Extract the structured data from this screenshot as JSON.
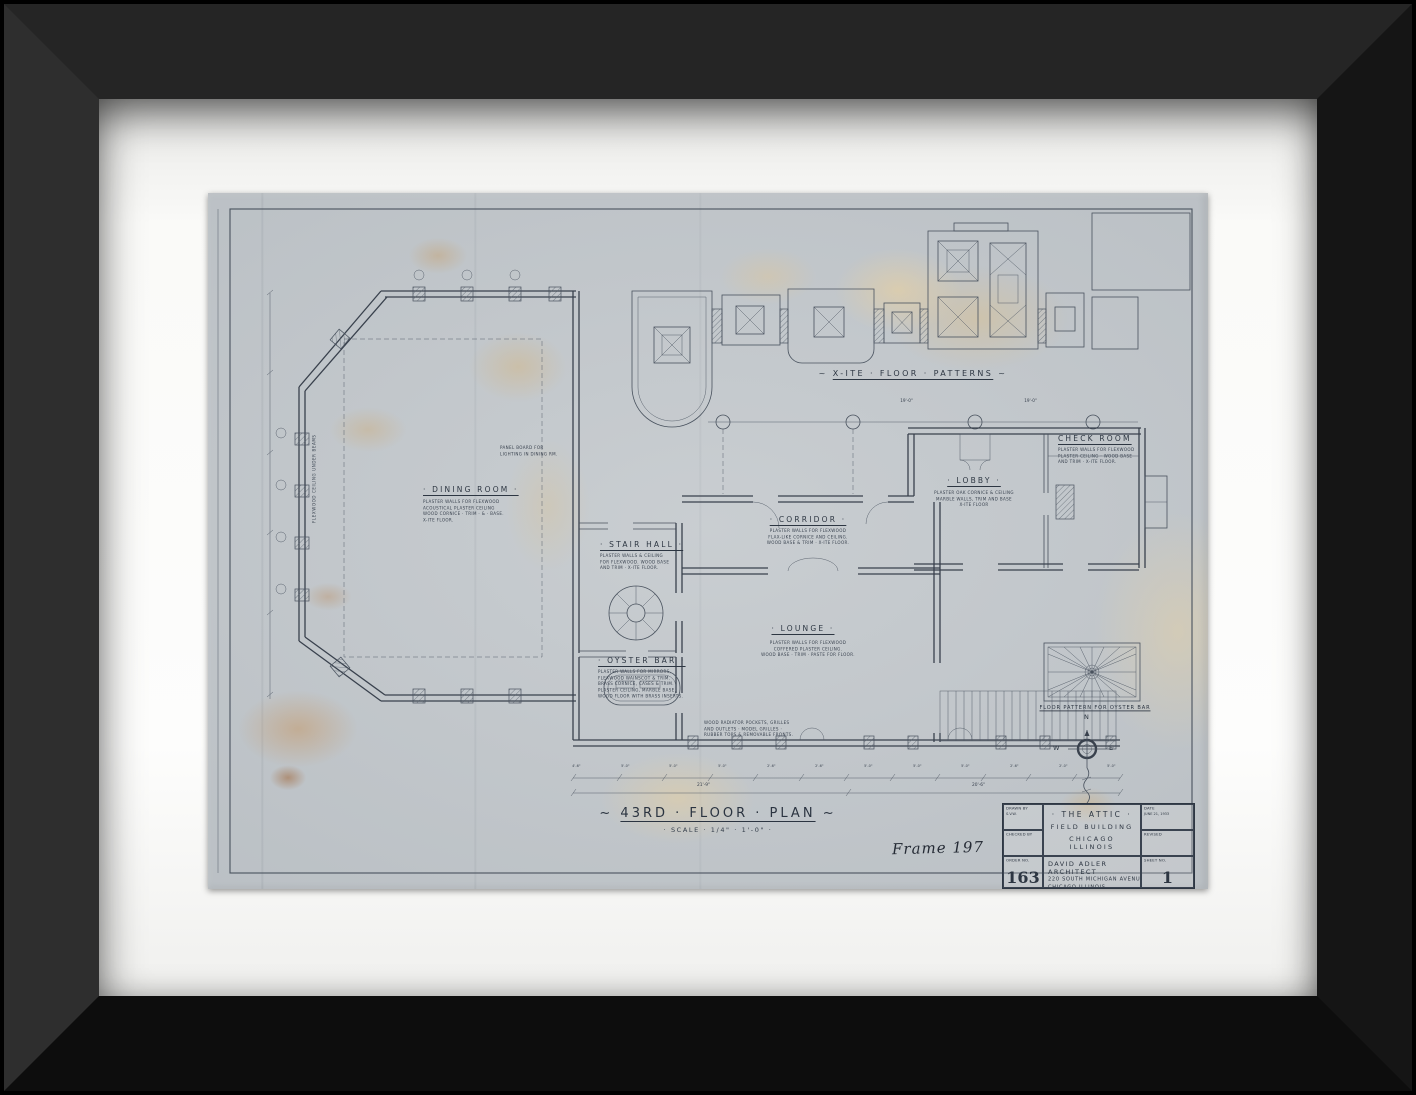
{
  "drawing": {
    "title_prefix": "~",
    "title_main": "43RD · FLOOR · PLAN",
    "title_suffix": "~",
    "scale_note": "· SCALE · 1/4\" · 1'-0\" ·",
    "handwritten_note": "Frame 197",
    "patterns_prefix": "~",
    "patterns_main": "X-ITE · FLOOR · PATTERNS",
    "patterns_suffix": "~",
    "patterns_dim_left": "19'-0\"",
    "patterns_dim_right": "19'-0\"",
    "oyster_pattern_caption": "FLOOR PATTERN FOR OYSTER BAR",
    "compass": {
      "north": "N",
      "west": "W",
      "east": "E"
    },
    "rooms": {
      "dining": {
        "name": "· DINING ROOM ·",
        "notes": "PLASTER WALLS FOR FLEXWOOD\nACOUSTICAL PLASTER CEILING\nWOOD CORNICE · TRIM · & · BASE.\nX-ITE FLOOR."
      },
      "stair_hall": {
        "name": "· STAIR HALL ·",
        "notes": "PLASTER WALLS & CEILING\nFOR FLEXWOOD. WOOD BASE\nAND TRIM · X-ITE FLOOR."
      },
      "oyster_bar": {
        "name": "· OYSTER BAR ·",
        "notes": "PLASTER WALLS FOR MIRRORS,\nFLEXWOOD WAINSCOT & TRIM.\nBRASS CORNICE, CASES & TRIM.\nPLASTER CEILING, MARBLE BASE.\nWOOD FLOOR WITH BRASS INSERTS."
      },
      "lounge": {
        "name": "· LOUNGE ·",
        "notes": "PLASTER WALLS FOR FLEXWOOD\nCOFFERED PLASTER CEILING.\nWOOD BASE · TRIM · PASTE FOR FLOOR."
      },
      "corridor": {
        "name": "· CORRIDOR ·",
        "notes": "PLASTER WALLS FOR FLEXWOOD\nFLAX-LIKE CORNICE AND CEILING.\nWOOD BASE & TRIM · X-ITE FLOOR."
      },
      "lobby": {
        "name": "· LOBBY ·",
        "notes": "PLASTER OAK CORNICE & CEILING\nMARBLE WALLS, TRIM AND BASE\nX-ITE FLOOR"
      },
      "check_room": {
        "name": "CHECK ROOM",
        "notes": "PLASTER WALLS FOR FLEXWOOD\nPLASTER CEILING · WOOD BASE\nAND TRIM · X-ITE FLOOR."
      }
    },
    "misc_notes": {
      "radiator": "WOOD RADIATOR POCKETS, GRILLES\nAND OUTLETS · MODEL GRILLES ·\nRUBBER TOPS & REMOVABLE FRONTS.",
      "panel_board": "PANEL BOARD FOR\nLIGHTING IN DINING RM.",
      "flexwood_ceiling": "FLEXWOOD CEILING UNDER BEAMS"
    },
    "dimensions": {
      "bottom_segments": [
        "4'-6\"",
        "5'-0\"",
        "5'-0\"",
        "5'-0\"",
        "2'-6\"",
        "2'-6\"",
        "5'-0\"",
        "5'-0\"",
        "5'-0\"",
        "2'-6\"",
        "2'-0\"",
        "5'-0\""
      ],
      "bottom_total_left": "21'-9\"",
      "bottom_total_right": "20'-6\""
    },
    "title_block": {
      "drawn_by_label": "DRAWN BY",
      "drawn_by_value": "S.V.W.",
      "checked_by_label": "CHECKED BY",
      "order_label": "ORDER NO.",
      "order_value": "163",
      "date_label": "DATE",
      "date_value": "JUNE 21, 1933",
      "revised_label": "REVISED",
      "sheet_label": "SHEET NO.",
      "sheet_value": "1",
      "project_line1": "· THE ATTIC ·",
      "project_line2": "FIELD BUILDING",
      "project_line3": "CHICAGO ILLINOIS",
      "architect_line1": "DAVID ADLER ARCHITECT",
      "architect_line2": "220 SOUTH MICHIGAN AVENUE",
      "architect_line3": "CHICAGO ILLINOIS"
    }
  }
}
